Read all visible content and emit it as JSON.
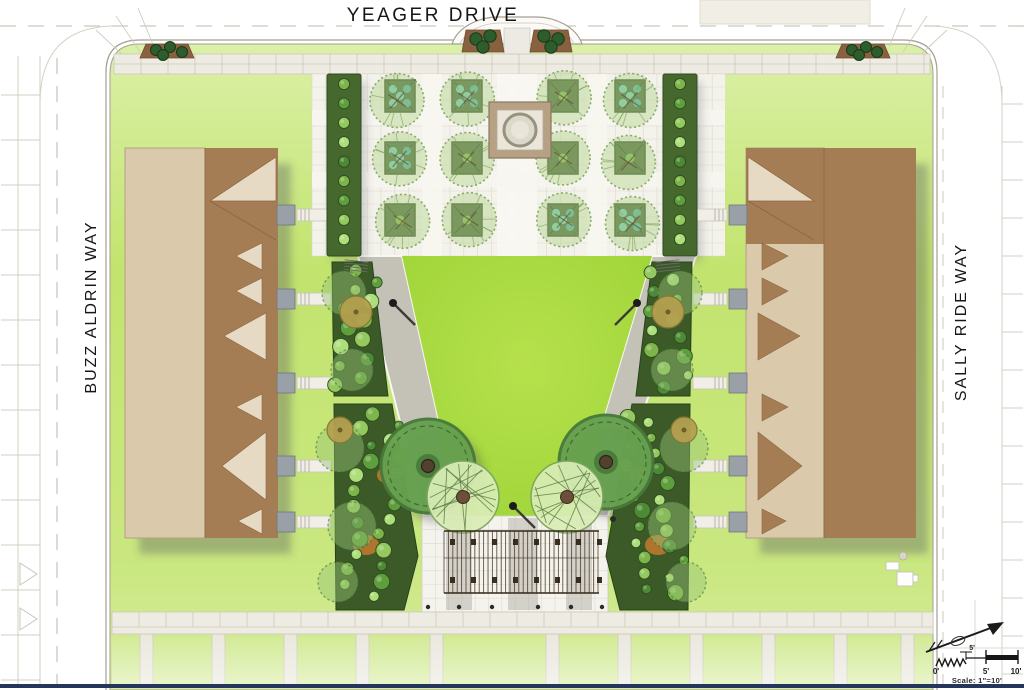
{
  "page": {
    "type": "landscape-architecture-site-plan",
    "description": "Color rendered courtyard site plan between two residential buildings"
  },
  "streets": {
    "top_label": "YEAGER DRIVE",
    "left_label": "BUZZ ALDRIN WAY",
    "right_label": "SALLY RIDE WAY"
  },
  "scale_bar": {
    "tick_labels": [
      "0'",
      "5'",
      "10'"
    ],
    "segment_label": "5'",
    "caption": "Scale: 1\"=10'"
  },
  "palette": {
    "lawn_green": "#c4e678",
    "courtyard_lawn": "#a6d83e",
    "paving_light": "#f3f2eb",
    "walkway_gray": "#c4c2b7",
    "sidewalk": "#edebe2",
    "building_tan": "#dbc9ac",
    "building_tan_light": "#e6dac4",
    "roof_brown": "#a57d54",
    "planter_green": "#3c5a28",
    "shrub_green": "#7db54a",
    "shrub_teal": "#46a58c",
    "mulch_brown": "#8a6140",
    "mulch_orange": "#b9782f",
    "pergola_brown": "#4b3a28",
    "street_line": "#c9c6b9",
    "curb": "#a39f92",
    "border_navy": "#24365c"
  }
}
